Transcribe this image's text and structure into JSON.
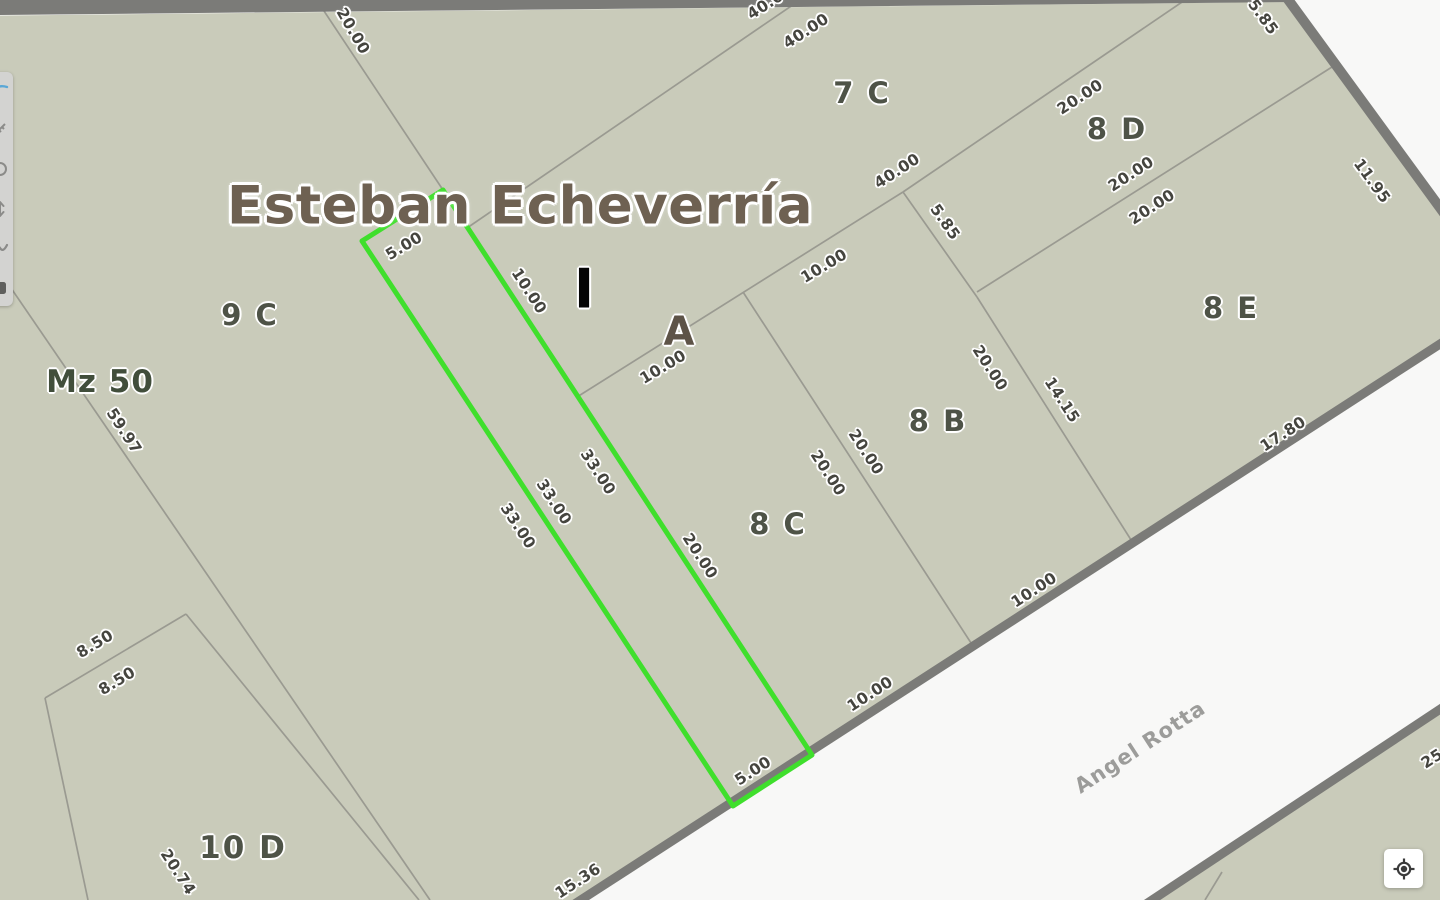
{
  "map": {
    "title": "Esteban Echeverría",
    "block_roman": "I",
    "parcel_letter": "A",
    "mz_label": "Mz 50",
    "street_name": "Angel Rotta",
    "parcels": [
      "7 C",
      "8 D",
      "8 E",
      "8 B",
      "8 C",
      "9 C",
      "10 D"
    ],
    "measurements": [
      "20.00",
      "40.00",
      "40.00",
      "40.00",
      "20.00",
      "20.00",
      "20.00",
      "5.85",
      "11.95",
      "5.85",
      "10.00",
      "10.00",
      "5.00",
      "10.00",
      "20.00",
      "14.15",
      "20.00",
      "20.00",
      "33.00",
      "33.00",
      "33.00",
      "20.00",
      "17.80",
      "10.00",
      "10.00",
      "5.00",
      "15.36",
      "59.97",
      "8.50",
      "8.50",
      "20.74",
      "25.00"
    ],
    "colors": {
      "block_fill": "#c9cbba",
      "street_fill": "#f8f8f7",
      "thick_border": "#7b7b78",
      "thin_line": "#9a9a91",
      "highlight_green": "#3fdf2c"
    }
  },
  "toolbar": {
    "icons": [
      {
        "name": "pan-icon"
      },
      {
        "name": "measure-icon"
      },
      {
        "name": "circle-tool-icon"
      },
      {
        "name": "vertical-move-icon"
      },
      {
        "name": "freehand-icon"
      },
      {
        "name": "layers-icon"
      }
    ]
  },
  "controls": {
    "locate_button_icon": "crosshair-target-icon"
  }
}
